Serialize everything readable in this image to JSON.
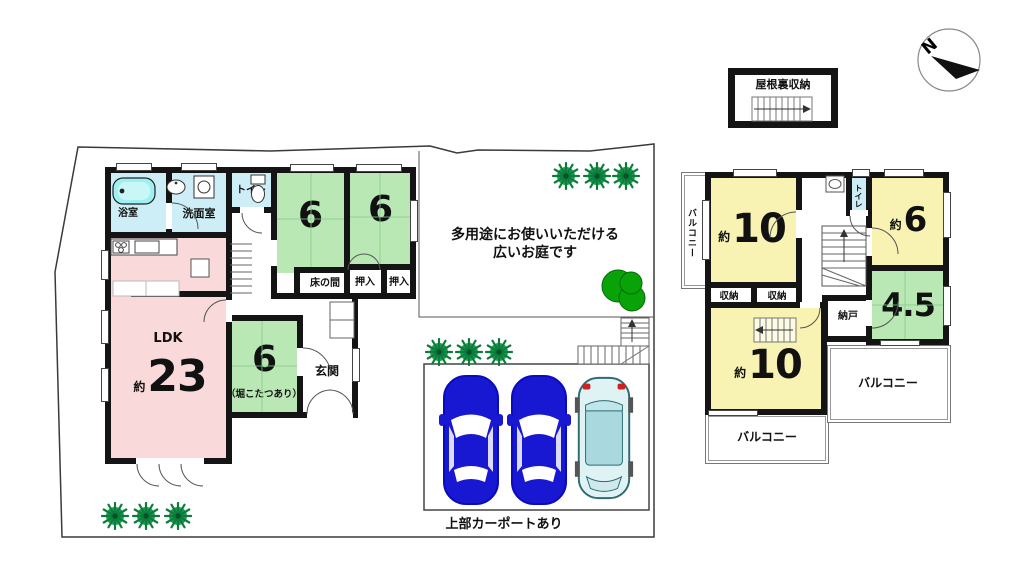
{
  "compass": {
    "north_label": "N"
  },
  "attic": {
    "label": "屋根裏収納"
  },
  "garden": {
    "caption_line1": "多用途にお使いいただける",
    "caption_line2": "広いお庭です"
  },
  "carport": {
    "caption": "上部カーポートあり"
  },
  "floor1": {
    "bath": "浴室",
    "washroom": "洗面室",
    "toilet": "トイレ",
    "room_a_size": "6",
    "room_a_alcove": "床の間",
    "room_b_size": "6",
    "room_b_closet_1": "押入",
    "room_b_closet_2": "押入",
    "ldk_name": "LDK",
    "ldk_approx": "約",
    "ldk_size": "23",
    "room_c_size": "6",
    "room_c_note": "（堀こたつあり）",
    "entrance": "玄関"
  },
  "floor2": {
    "balcony_left": "バルコニー",
    "balcony_bottom": "バルコニー",
    "balcony_right": "バルコニー",
    "room_nw_approx": "約",
    "room_nw_size": "10",
    "room_ne_approx": "約",
    "room_ne_size": "6",
    "room_se_size": "4.5",
    "room_sw_approx": "約",
    "room_sw_size": "10",
    "closet_1": "収納",
    "closet_2": "収納",
    "storeroom": "納戸",
    "toilet": "トイレ"
  },
  "colors": {
    "wall": "#141414",
    "tatami_green": "#b9e8b4",
    "room_yellow": "#f8f3b2",
    "wet_blue": "#cdeef6",
    "ldk_pink": "#f9d9da",
    "car_blue": "#1818d2",
    "car_light": "#dff2f4",
    "foliage_green": "#17a04c",
    "tree_green": "#09a309"
  }
}
